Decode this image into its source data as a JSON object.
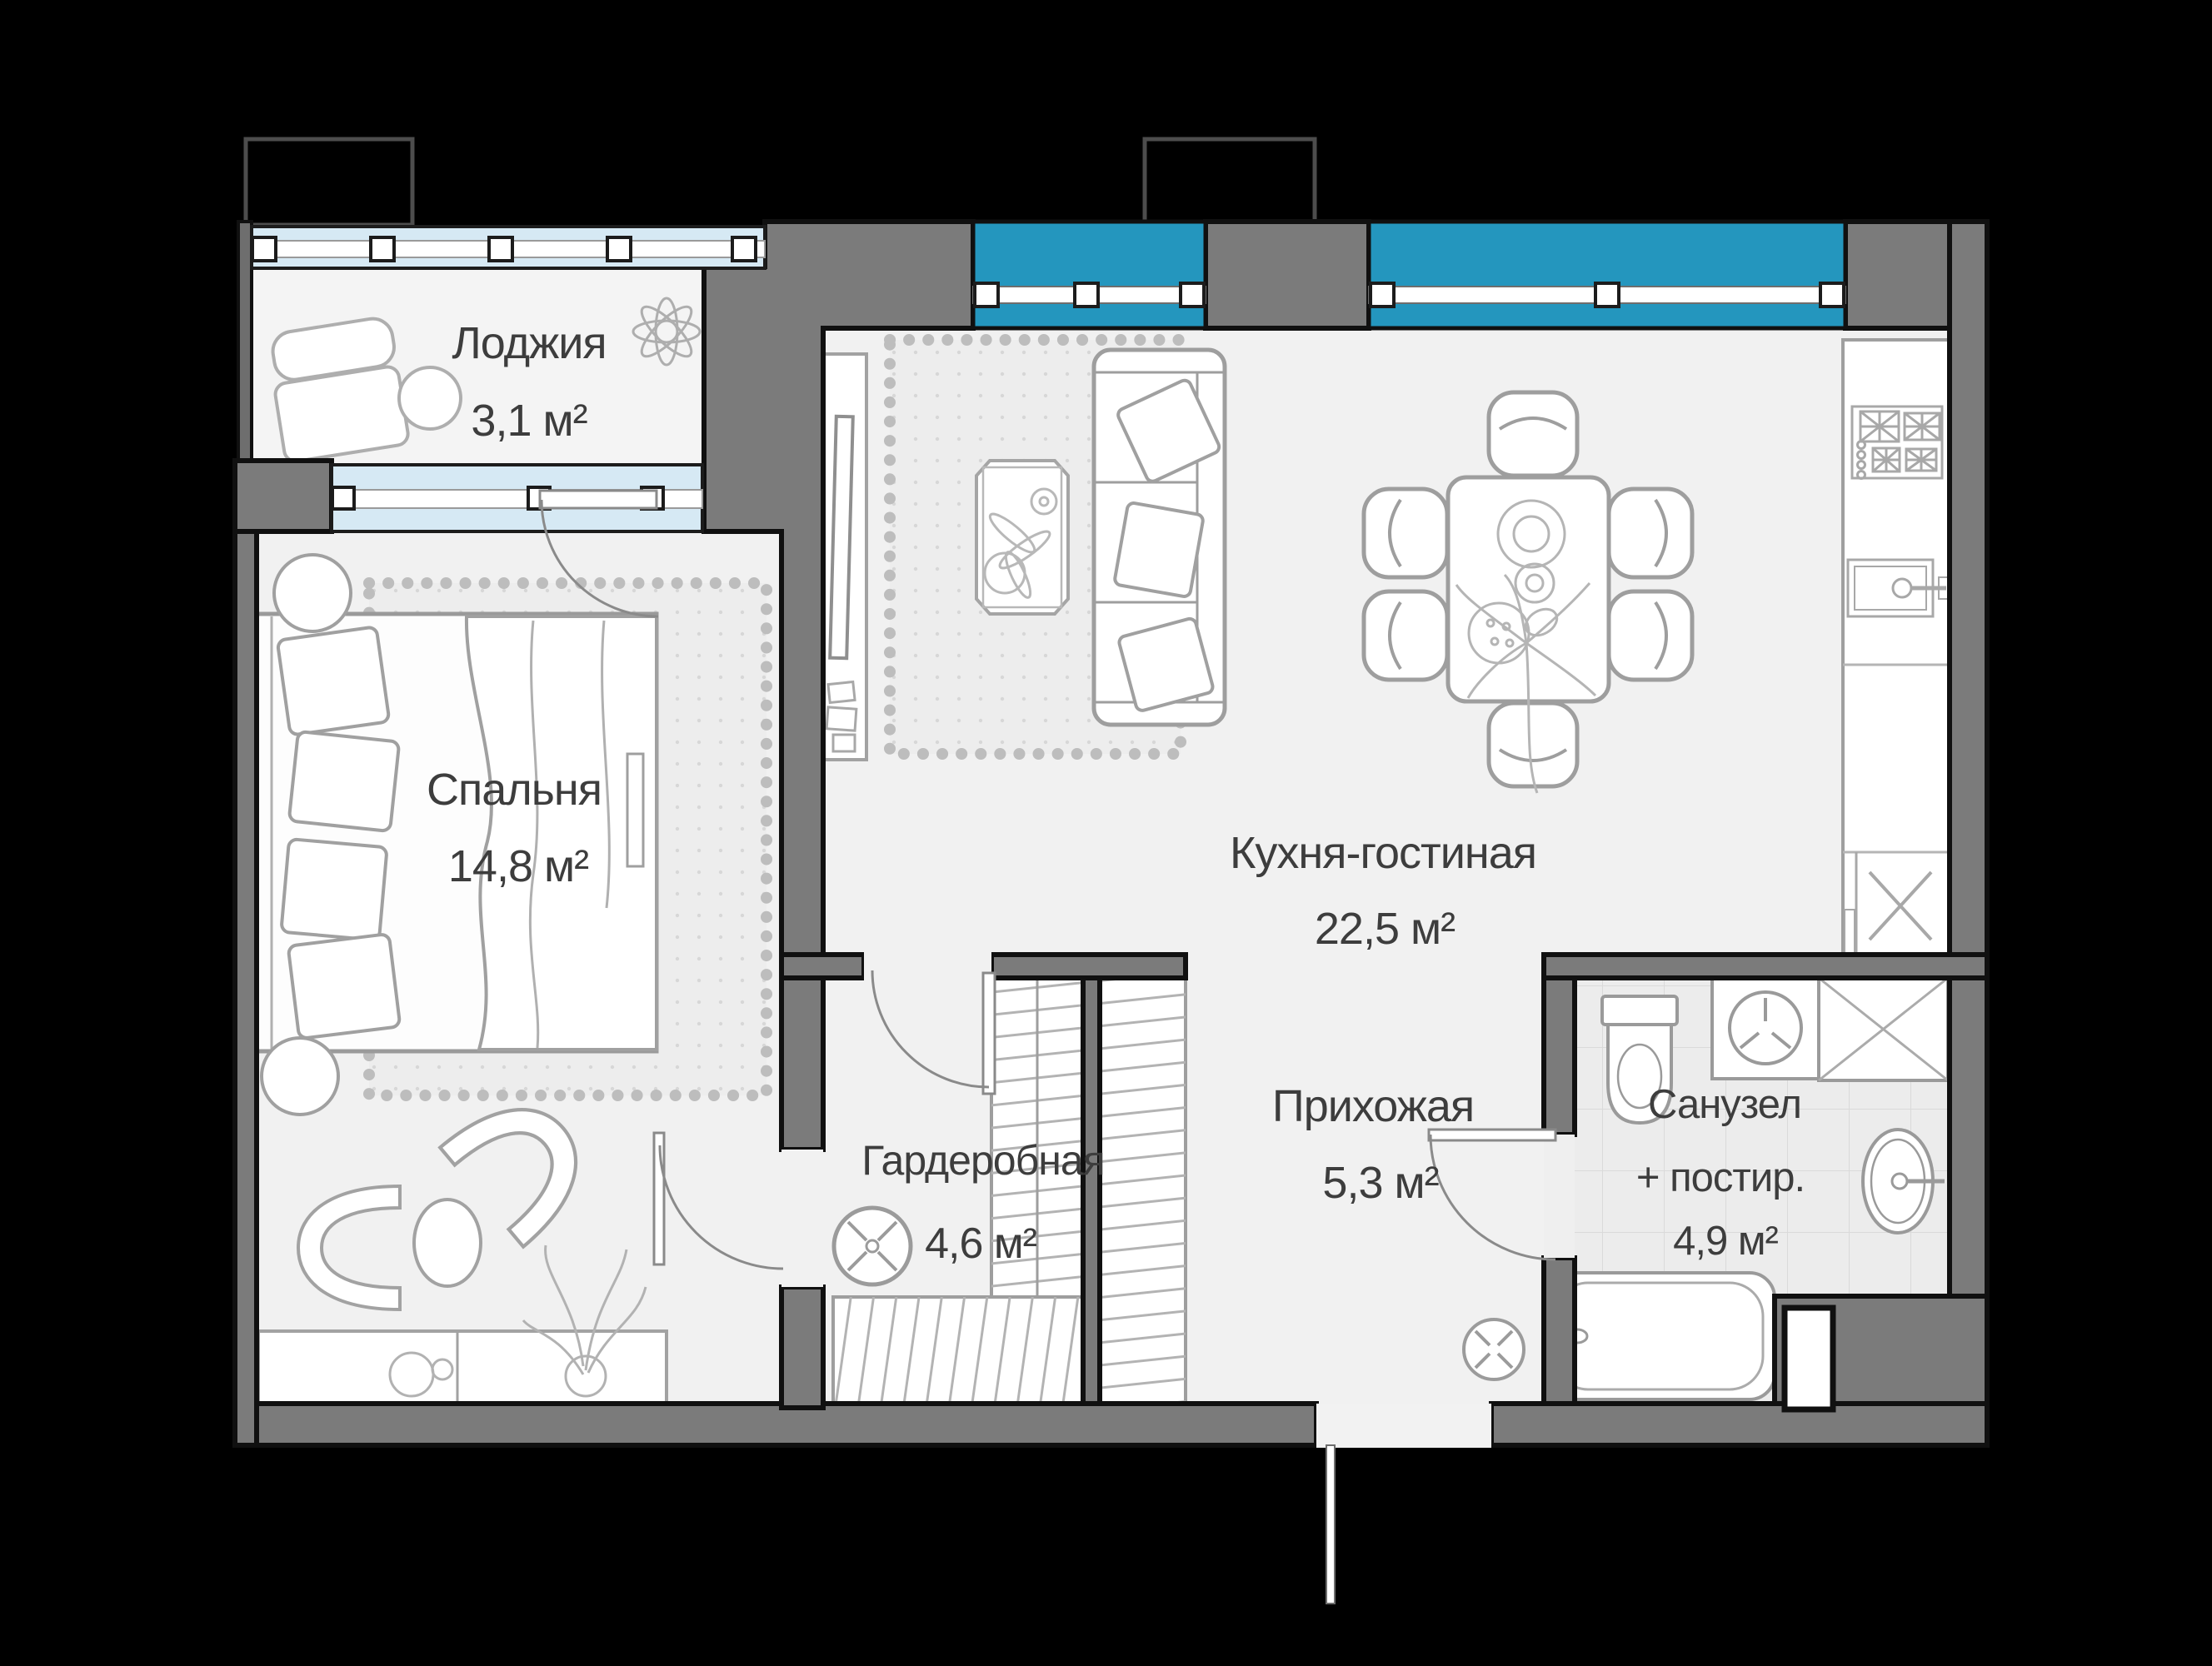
{
  "plan": {
    "type": "apartment-floor-plan",
    "background": "#000000",
    "wall_color": "#7b7b7b",
    "window_color": "#2496be",
    "loggia_glazing_color": "#d6e9f4",
    "floor_color": "#f1f1f1",
    "rooms": [
      {
        "id": "loggia",
        "name": "Лоджия",
        "area": "3,1 м²"
      },
      {
        "id": "bedroom",
        "name": "Спальня",
        "area": "14,8 м²"
      },
      {
        "id": "kitchen",
        "name": "Кухня-гостиная",
        "area": "22,5 м²"
      },
      {
        "id": "wardrobe",
        "name": "Гардеробная",
        "area": "4,6 м²"
      },
      {
        "id": "hallway",
        "name": "Прихожая",
        "area": "5,3 м²"
      },
      {
        "id": "bathroom",
        "name": "Санузел",
        "name2": "+ постир.",
        "area": "4,9 м²"
      }
    ],
    "icons": [
      "bed",
      "pillow",
      "nightstand",
      "armchair",
      "side-table",
      "console",
      "plant",
      "mirror",
      "rug",
      "coffee-table",
      "sofa",
      "tv-console",
      "tv",
      "dining-table",
      "dining-chair",
      "kitchen-counter",
      "stove",
      "kitchen-sink",
      "cabinet-x",
      "toilet",
      "washing-machine",
      "shower",
      "bath-sink",
      "bathtub",
      "vent-fan",
      "window",
      "balcony-door",
      "door-swing",
      "entry-door",
      "wardrobe-rail",
      "duct"
    ]
  }
}
